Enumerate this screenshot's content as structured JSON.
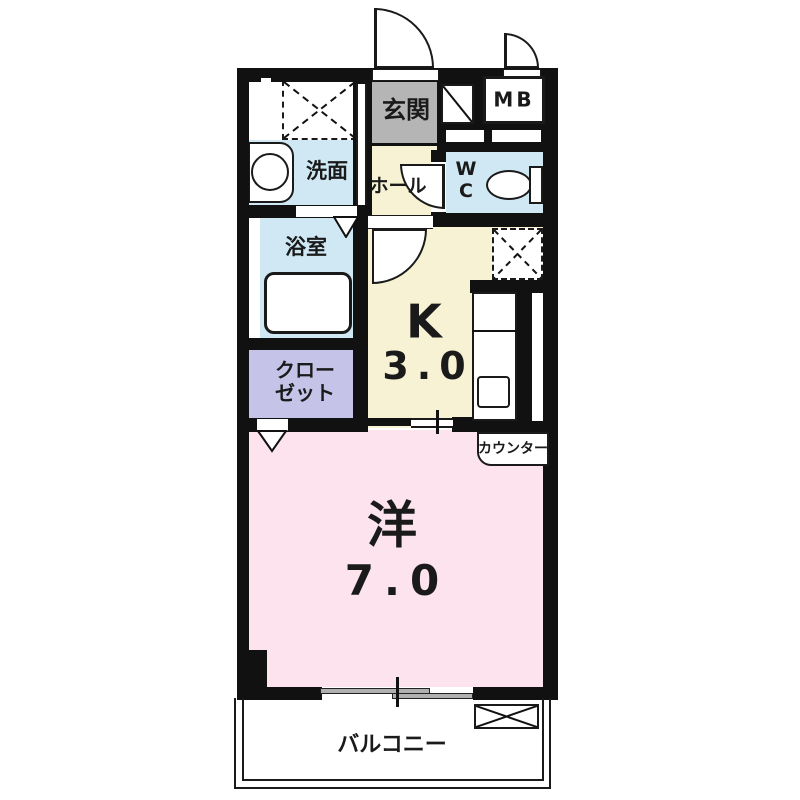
{
  "floorplan": {
    "rooms": {
      "entrance": {
        "label": "玄関"
      },
      "meter_box": {
        "label": "MB"
      },
      "washroom": {
        "label": "洗面"
      },
      "hall": {
        "label": "ホール"
      },
      "toilet": {
        "label_line1": "W",
        "label_line2": "C"
      },
      "bathroom": {
        "label": "浴室"
      },
      "closet": {
        "label_line1": "クロー",
        "label_line2": "ゼット"
      },
      "kitchen": {
        "label": "K",
        "size": "3.0"
      },
      "western_room": {
        "label": "洋",
        "size": "7.0"
      },
      "counter": {
        "label": "カウンター"
      },
      "balcony": {
        "label": "バルコニー"
      }
    },
    "colors": {
      "wall": "#111111",
      "pink": "#fce3ed",
      "yellow": "#f6f2d3",
      "blue": "#cfe8f4",
      "purple": "#c6c3e8",
      "gray": "#b5b5b6",
      "ink": "#1a1a1a"
    }
  }
}
